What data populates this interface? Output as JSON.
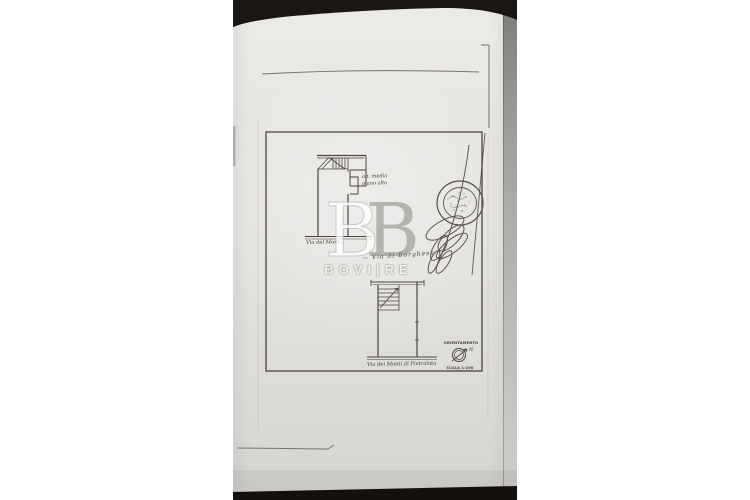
{
  "watermark": {
    "monogram_letter1": "B",
    "monogram_letter2": "B",
    "name": "BOVI|RE",
    "gray": "#8a8885",
    "white": "#ffffff"
  },
  "plan": {
    "streets": {
      "upper": "Via del Mont...",
      "middle": "Via di Borghese",
      "lower": "Via dei Monti di Pietralata"
    },
    "notes": {
      "line1": "alt. media",
      "line2": "piano alto"
    },
    "orientation": {
      "label": "ORIENTAMENTO",
      "north": "N",
      "scale": "SCALA 1:200"
    }
  },
  "colors": {
    "page_background": "#ffffff",
    "paper": "#e7e5e2",
    "ink": "#4a463f",
    "pencil": "#78746d",
    "dark_band": "#17130f",
    "edge_strip": "#b7b5b2"
  }
}
